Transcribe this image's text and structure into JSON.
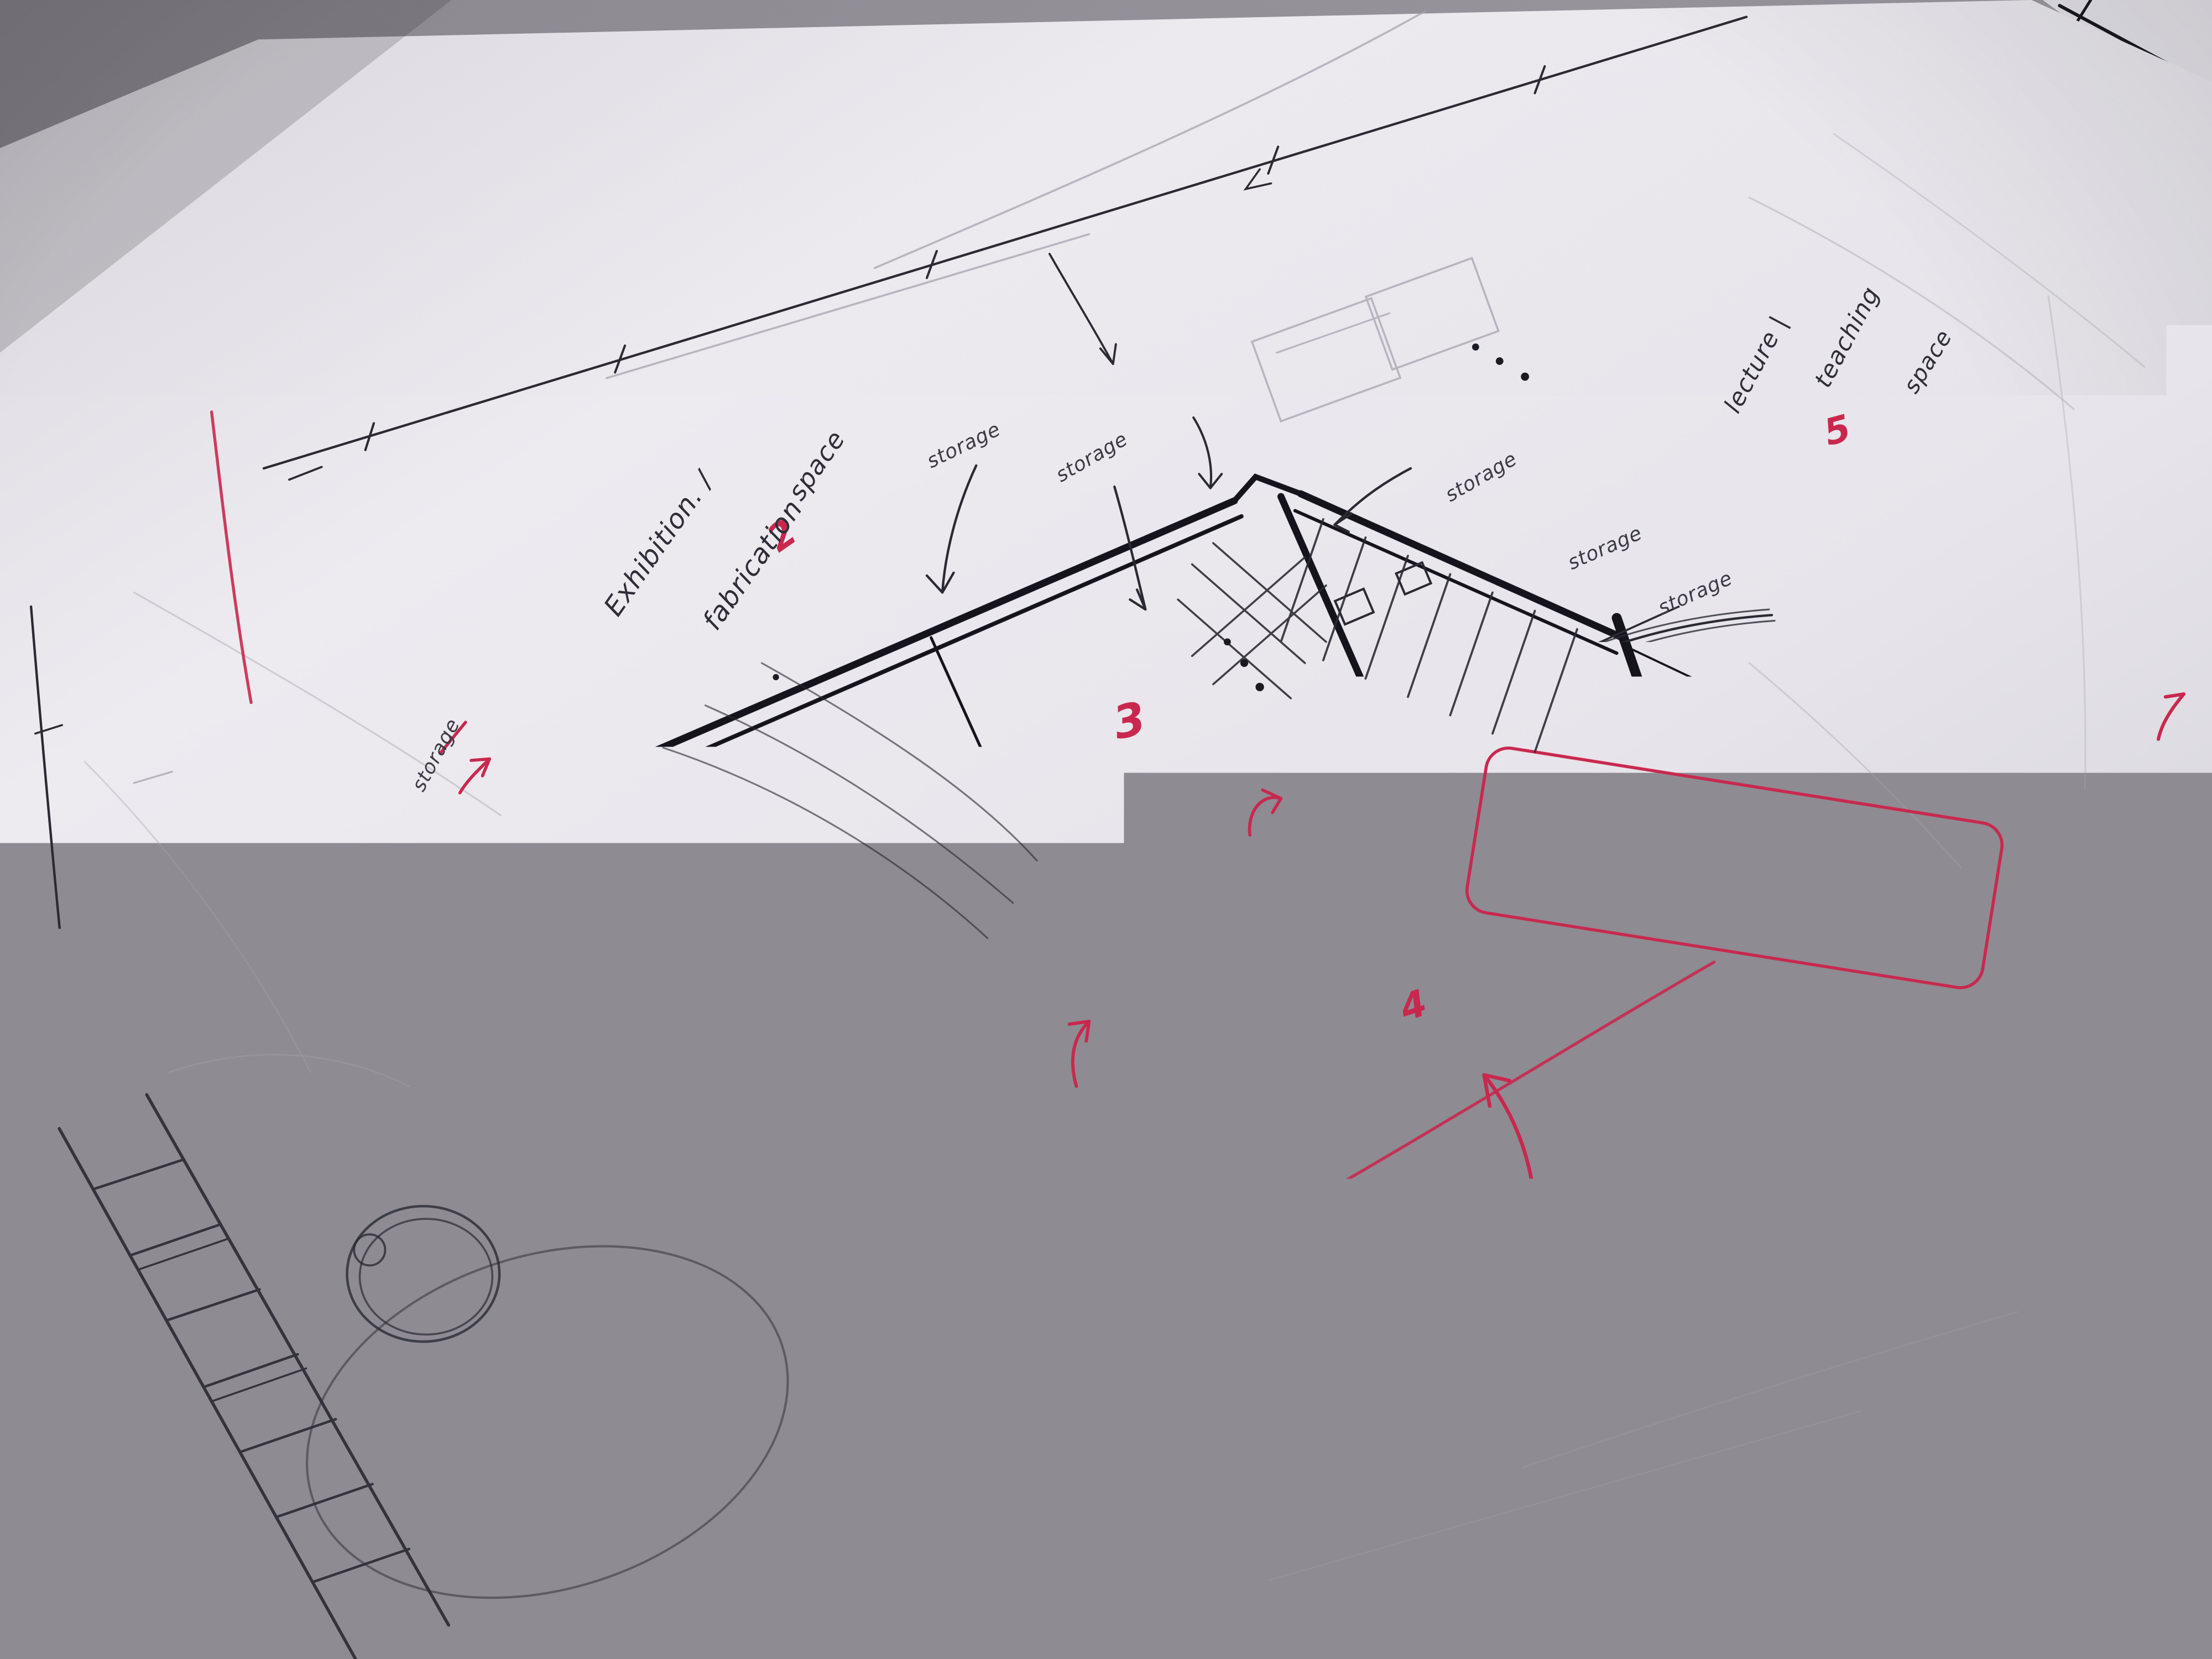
{
  "sketch": {
    "room_labels": {
      "exhibition": "Exhibition. /",
      "fabrication": "fabrication",
      "fabrication_space": "space",
      "darkroom": "Darkroom",
      "open": "open...",
      "it_lecture": "IT / lecture Rm.",
      "bar": "Bar.",
      "lecture": "lecture |",
      "teaching": "teaching",
      "teaching_space": "space"
    },
    "storage_labels": [
      "storage",
      "storage",
      "storage",
      "storage",
      "storage",
      "storage"
    ],
    "red_numbers": [
      "1",
      "2",
      "3",
      "4",
      "5"
    ],
    "blue_number": "6",
    "dimensions": {
      "d_50": "5.0",
      "d_8": "8",
      "d_25m": "2.5m",
      "d_800": "800",
      "d_1000": "1000"
    },
    "colors": {
      "ink": "#15141c",
      "pen": "#2b2a33",
      "red_ink": "#c9284e",
      "pink_line": "#e05a78",
      "blue_ink": "#3050c0",
      "pencil": "#a6a3b0",
      "paper": "#eae8ee",
      "table": "#97949c"
    }
  }
}
